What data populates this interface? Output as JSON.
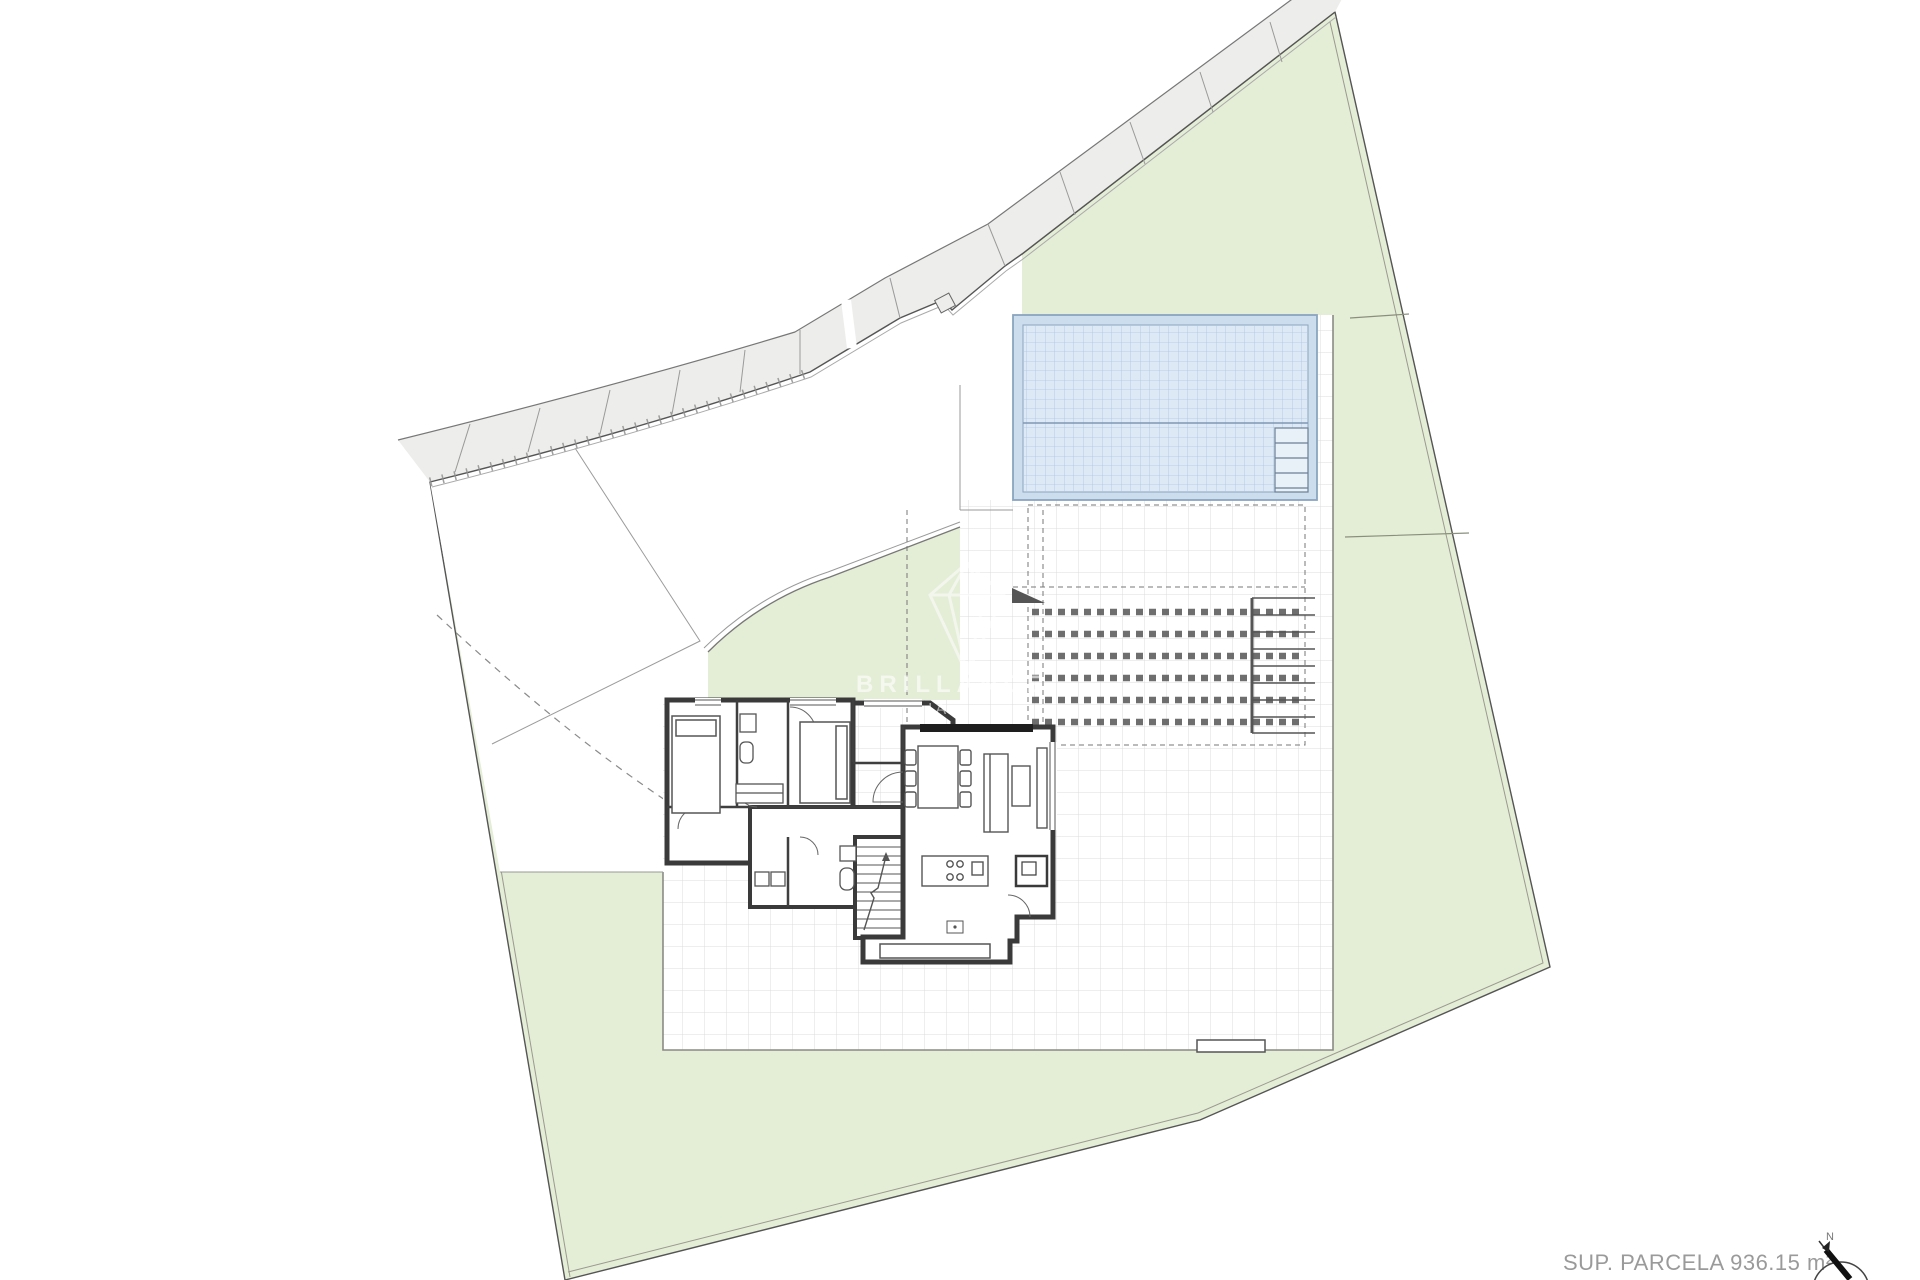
{
  "plan": {
    "type": "site-and-floor-plan",
    "regions": [
      "parcel",
      "garden",
      "sidewalk-road",
      "driveway",
      "swimming-pool",
      "pool-steps",
      "paved-terrace",
      "pergola",
      "outdoor-stair",
      "house",
      "bedroom-1",
      "bedroom-2",
      "bathroom-1",
      "bathroom-2",
      "laundry",
      "hallway",
      "stairs",
      "entrance-porch",
      "living-dining-room",
      "kitchen-island",
      "dining-table",
      "sofa"
    ],
    "area_label": "SUP. PARCELA 936.15 m²"
  },
  "watermark": {
    "logo": "diamond-logo",
    "line1": "BRILLANCE",
    "line2": "IA"
  },
  "compass": {
    "icon": "north-arrow-icon",
    "label": "N"
  },
  "colors": {
    "garden_green": "#e4edd6",
    "garden_edge": "#8a8f7d",
    "road_gray": "#ededeb",
    "pool_deck": "#ccdded",
    "pool_water": "#dde9f5",
    "pool_grid": "#a9c6df",
    "terrace_grid": "#dcdcdc",
    "wall_dark": "#3a3a3a",
    "boundary": "#555555",
    "label_gray": "#9a9a9a"
  }
}
